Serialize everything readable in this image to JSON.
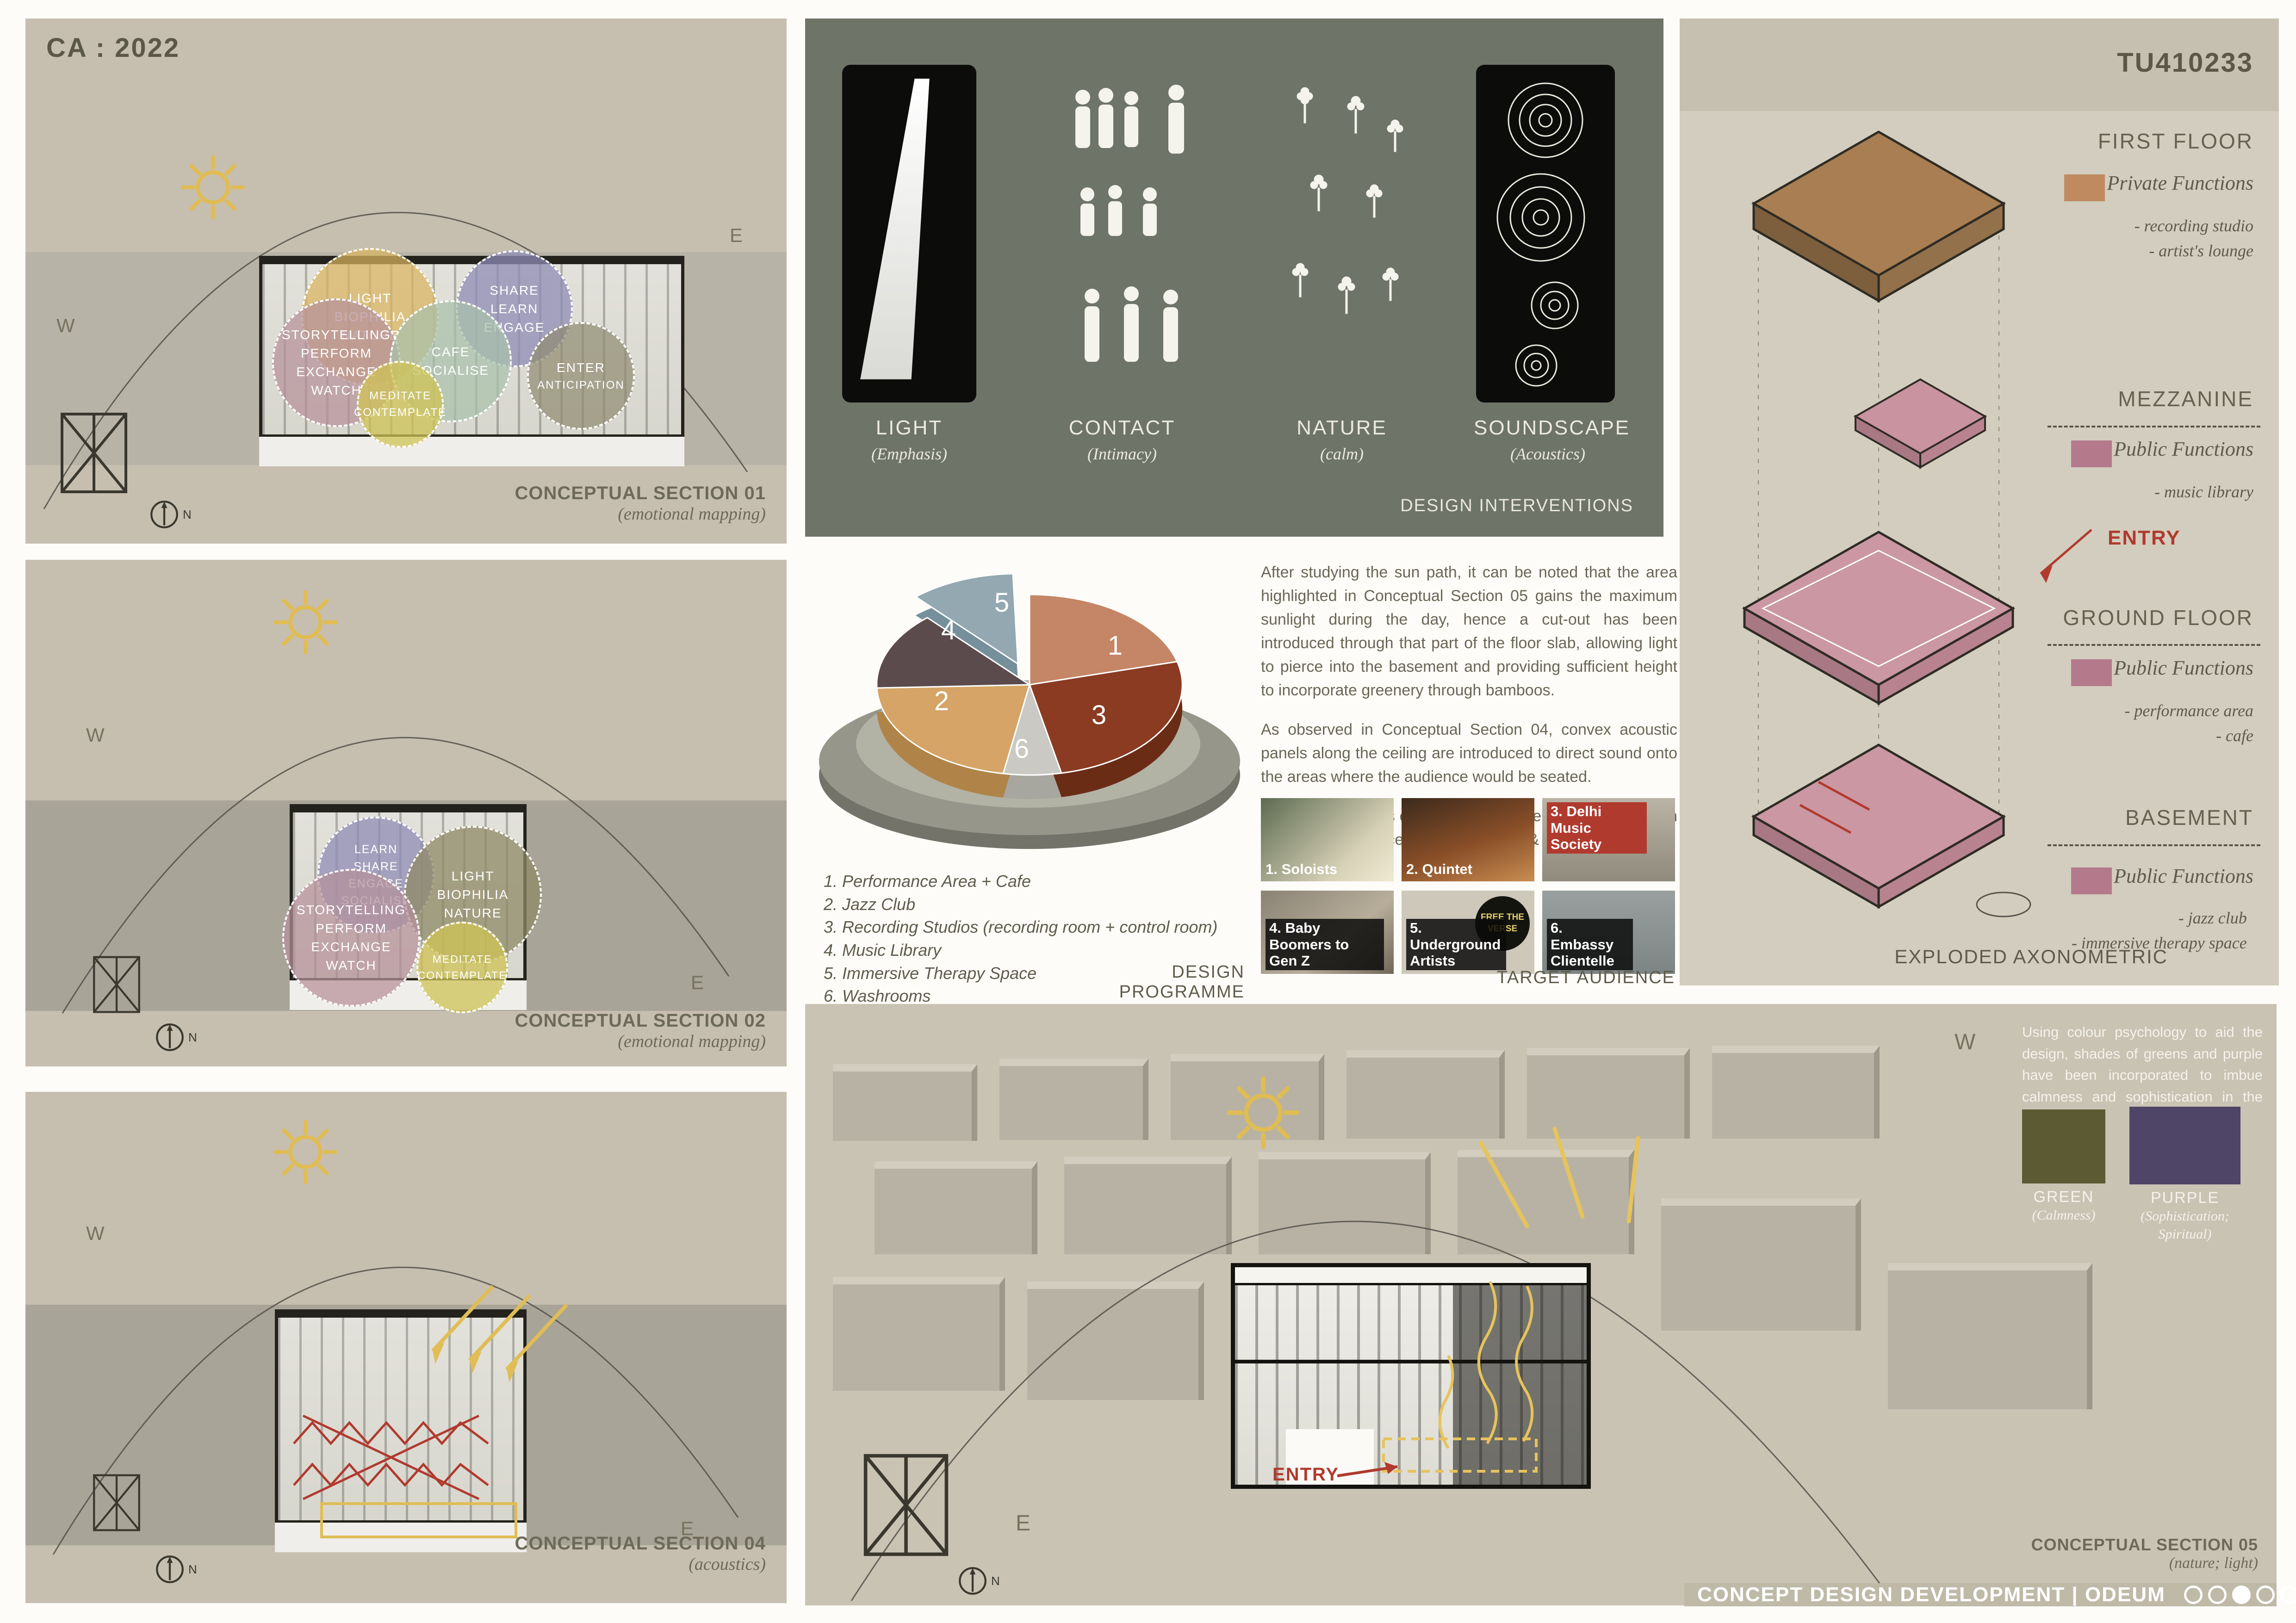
{
  "board": {
    "code_left": "CA : 2022",
    "code_right": "TU410233",
    "compass": "N",
    "footer": {
      "title": "CONCEPT DESIGN DEVELOPMENT | ODEUM",
      "pages_total": 6,
      "active_page": 3
    }
  },
  "section01": {
    "caption": "CONCEPTUAL SECTION 01",
    "subcaption": "(emotional mapping)",
    "west": "W",
    "east": "E",
    "bubbles": {
      "gold": [
        "LIGHT",
        "BIOPHILIA",
        "NATURE"
      ],
      "purple": [
        "SHARE",
        "LEARN",
        "ENGAGE"
      ],
      "mauve": [
        "STORYTELLING",
        "PERFORM",
        "EXCHANGE",
        "WATCH"
      ],
      "green": [
        "CAFE",
        "SOCIALISE"
      ],
      "yellow": [
        "MEDITATE",
        "CONTEMPLATE"
      ],
      "khaki": [
        "ENTER",
        "ANTICIPATION"
      ]
    }
  },
  "section02": {
    "caption": "CONCEPTUAL SECTION 02",
    "subcaption": "(emotional mapping)",
    "west": "W",
    "east": "E",
    "bubbles": {
      "purple": [
        "LEARN",
        "SHARE",
        "ENGAGE",
        "SOCIALISE"
      ],
      "olive": [
        "LIGHT",
        "BIOPHILIA",
        "NATURE"
      ],
      "mauve": [
        "STORYTELLING",
        "PERFORM",
        "EXCHANGE",
        "WATCH"
      ],
      "yellow": [
        "MEDITATE",
        "CONTEMPLATE"
      ]
    }
  },
  "section04": {
    "caption": "CONCEPTUAL SECTION 04",
    "subcaption": "(acoustics)",
    "west": "W",
    "east": "E"
  },
  "interventions": {
    "caption": "DESIGN INTERVENTIONS",
    "items": [
      {
        "title": "LIGHT",
        "sub": "(Emphasis)"
      },
      {
        "title": "CONTACT",
        "sub": "(Intimacy)"
      },
      {
        "title": "NATURE",
        "sub": "(calm)"
      },
      {
        "title": "SOUNDSCAPE",
        "sub": "(Acoustics)"
      }
    ]
  },
  "chart_data": {
    "type": "pie",
    "title": "DESIGN PROGRAMME",
    "legend_position": "below-left",
    "slices": [
      {
        "id": "1",
        "label": "Performance Area + Cafe",
        "value": 21,
        "color": "#c48666"
      },
      {
        "id": "2",
        "label": "Jazz Club",
        "value": 22,
        "color": "#d5a466"
      },
      {
        "id": "3",
        "label": "Recording Studios (recording room + control room)",
        "value": 26,
        "color": "#8a3b22"
      },
      {
        "id": "4",
        "label": "Music Library",
        "value": 13,
        "color": "#5c4b4c"
      },
      {
        "id": "5",
        "label": "Immersive Therapy Space",
        "value": 12,
        "color": "#93a8b1"
      },
      {
        "id": "6",
        "label": "Washrooms",
        "value": 6,
        "color": "#c9c9c3"
      }
    ]
  },
  "programme": {
    "caption": "DESIGN PROGRAMME",
    "items": [
      "1. Performance Area + Cafe",
      "2. Jazz Club",
      "3. Recording Studios (recording room + control room)",
      "4. Music Library",
      "5. Immersive Therapy Space",
      "6. Washrooms"
    ]
  },
  "narrative": {
    "p1": "After studying the sun path, it can be noted that the area highlighted in Conceptual Section 05 gains the maximum sunlight during the day, hence a cut-out has been introduced through that part of the floor slab, allowing light to pierce into the basement and providing sufficient height to incorporate greenery through bamboos.",
    "p2": "As observed in Conceptual Section 04, convex acoustic panels along the ceiling are introduced to direct sound onto the areas where the audience would be seated.",
    "p3": "While the emotions evoked in the different levels have been highlighted in Conceptual Sections 01 & 02."
  },
  "audience": {
    "caption": "TARGET AUDIENCE",
    "badge": "FREE THE VERSE",
    "items": [
      "1. Soloists",
      "2. Quintet",
      "3. Delhi Music Society",
      "4. Baby Boomers to Gen Z",
      "5. Underground Artists",
      "6. Embassy Clientelle"
    ]
  },
  "axonometric": {
    "caption": "EXPLODED AXONOMETRIC",
    "entry": "ENTRY",
    "floors": [
      {
        "name": "FIRST FLOOR",
        "function": "Private Functions",
        "swatch": "#bf8a60",
        "items": [
          "- recording studio",
          "- artist's lounge"
        ]
      },
      {
        "name": "MEZZANINE",
        "function": "Public Functions",
        "swatch": "#b5798c",
        "items": [
          "- music library"
        ]
      },
      {
        "name": "GROUND FLOOR",
        "function": "Public Functions",
        "swatch": "#b5798c",
        "items": [
          "- performance area",
          "- cafe"
        ]
      },
      {
        "name": "BASEMENT",
        "function": "Public Functions",
        "swatch": "#b5798c",
        "items": [
          "- jazz club",
          "- immersive therapy space"
        ]
      }
    ]
  },
  "section05": {
    "caption": "CONCEPTUAL SECTION 05",
    "subcaption": "(nature; light)",
    "west": "W",
    "east": "E",
    "entry": "ENTRY",
    "text": "Using colour psychology to aid the design, shades of greens and purple have been incorporated to imbue calmness and sophistication in the space.",
    "swatches": [
      {
        "name": "GREEN",
        "sub": "(Calmness)",
        "color": "#5b5a33"
      },
      {
        "name": "PURPLE",
        "sub": "(Sophistication; Spiritual)",
        "color": "#4f4566"
      }
    ]
  }
}
